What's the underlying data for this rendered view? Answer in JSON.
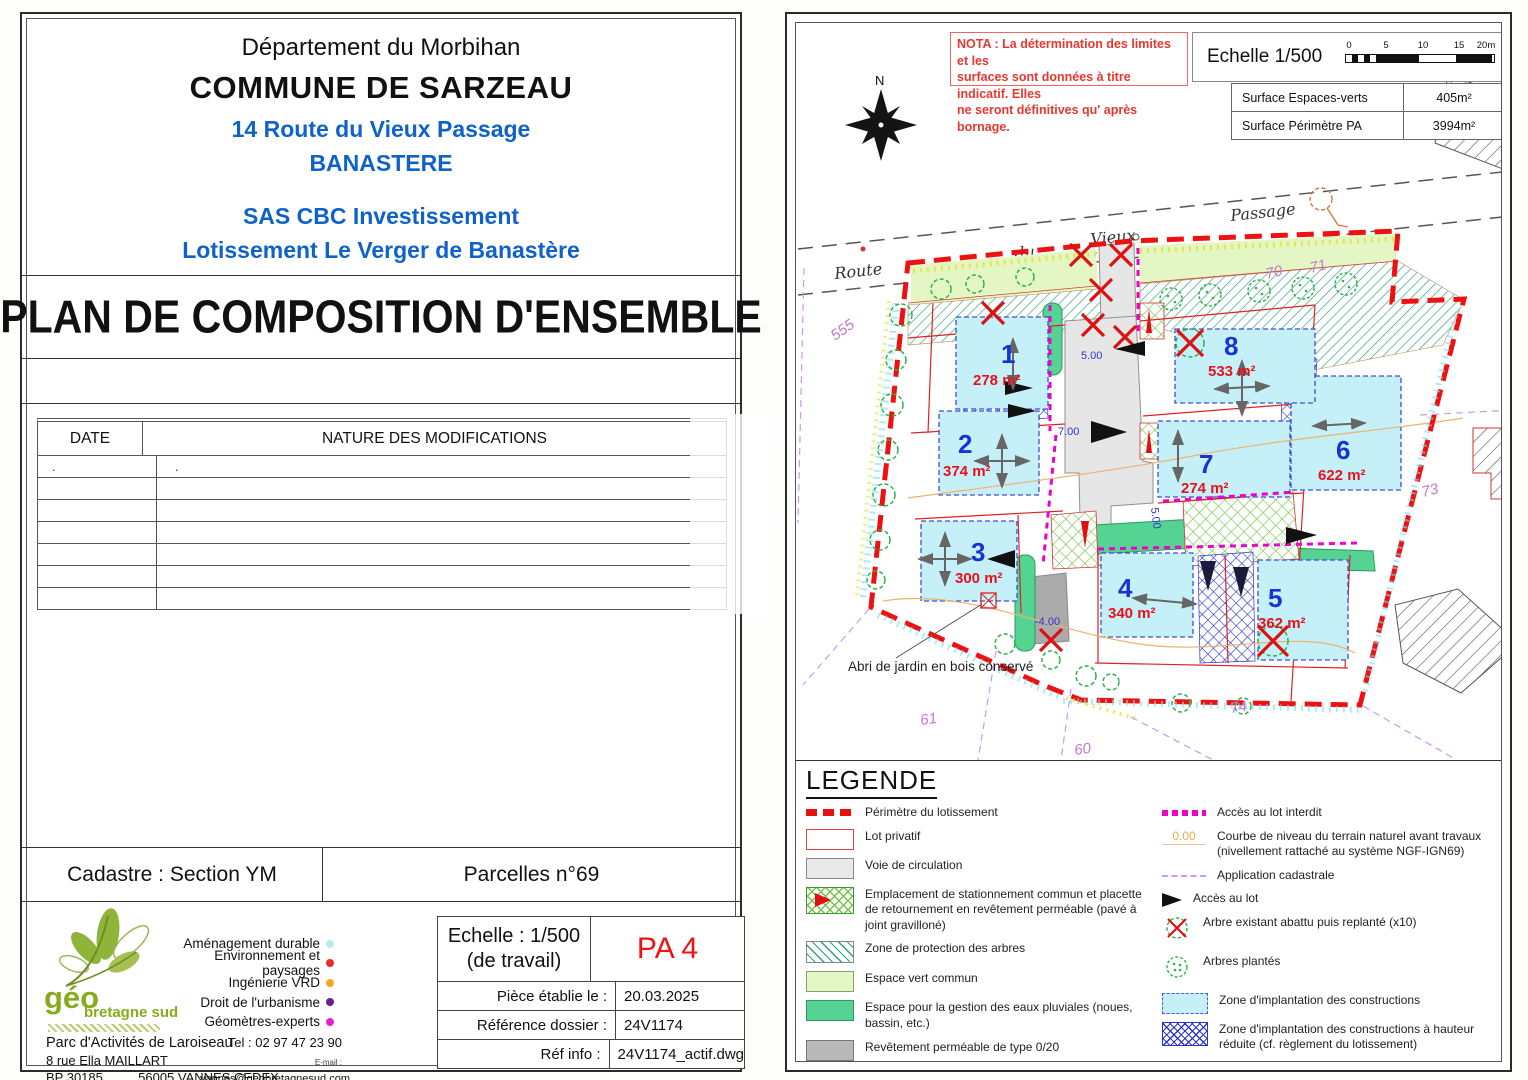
{
  "left_sheet": {
    "header": {
      "dept": "Département du Morbihan",
      "commune": "COMMUNE DE SARZEAU",
      "address": "14 Route du Vieux Passage",
      "locality": "BANASTERE",
      "applicant": "SAS CBC Investissement",
      "project": "Lotissement Le Verger de Banastère"
    },
    "title": "PLAN DE COMPOSITION D'ENSEMBLE",
    "modifications": {
      "col_date": "DATE",
      "col_nature": "NATURE DES MODIFICATIONS",
      "first_row_date": ".",
      "first_row_nature": "."
    },
    "cadastre_label": "Cadastre : Section YM",
    "parcelles_label": "Parcelles n°69",
    "firm": {
      "logo_text1": "géo",
      "logo_text2": "bretagne sud",
      "services": [
        {
          "label": "Aménagement durable",
          "color": "#b5eef2"
        },
        {
          "label": "Environnement et paysages",
          "color": "#e62b2b"
        },
        {
          "label": "Ingénierie VRD",
          "color": "#f5a81c"
        },
        {
          "label": "Droit de l'urbanisme",
          "color": "#6a1f8a"
        },
        {
          "label": "Géomètres-experts",
          "color": "#ea1fd0"
        }
      ],
      "address1": "Parc d'Activités de Laroiseau",
      "address2": "8 rue Ella MAILLART",
      "address3a": "BP 30185",
      "address3b": "56005 VANNES CEDEX",
      "tel": "Tel : 02 97 47 23 90",
      "email_label": "E-mail :",
      "email": "vannes@geobretagnesud.com",
      "web_label": "Web :",
      "web": "www.geobretagnesud.com"
    },
    "cartouche": {
      "echelle1": "Echelle : 1/500",
      "echelle2": "(de travail)",
      "piece": "PA 4",
      "row1_label": "Pièce établie le :",
      "row1_value": "20.03.2025",
      "row2_label": "Référence dossier :",
      "row2_value": "24V1174",
      "row3_label": "Réf info :",
      "row3_value": "24V1174_actif.dwg"
    }
  },
  "plan": {
    "nota": {
      "line1": "NOTA : La détermination des limites et les",
      "line2": "surfaces sont données à titre indicatif. Elles",
      "line3": "ne  seront définitives qu' après bornage."
    },
    "scale": {
      "label": "Echelle 1/500",
      "ticks": [
        "0",
        "5",
        "10",
        "15",
        "20m"
      ]
    },
    "surfaces": [
      {
        "label": "Surface Espaces-verts",
        "value": "405m²"
      },
      {
        "label": "Surface Périmètre PA",
        "value": "3994m²"
      }
    ],
    "compass_label": "N",
    "road_words": [
      "Route",
      "du",
      "Vieux",
      "Passage"
    ],
    "lots": [
      {
        "num": "1",
        "area": "278 m²"
      },
      {
        "num": "2",
        "area": "374 m²"
      },
      {
        "num": "3",
        "area": "300 m²"
      },
      {
        "num": "4",
        "area": "340 m²"
      },
      {
        "num": "5",
        "area": "362 m²"
      },
      {
        "num": "6",
        "area": "622 m²"
      },
      {
        "num": "7",
        "area": "274 m²"
      },
      {
        "num": "8",
        "area": "533 m²"
      }
    ],
    "parcels": [
      {
        "text": "555"
      },
      {
        "text": "70"
      },
      {
        "text": "71"
      },
      {
        "text": "73"
      },
      {
        "text": "74"
      },
      {
        "text": "61"
      },
      {
        "text": "60"
      }
    ],
    "dims": [
      {
        "text": "5.00"
      },
      {
        "text": "7.00"
      },
      {
        "text": "-4.00"
      },
      {
        "text": "5.00"
      }
    ],
    "annotation": "Abri de jardin en bois conservé",
    "legend": {
      "title": "LEGENDE",
      "contour_value": "0.00",
      "left": [
        "Périmètre du lotissement",
        "Lot privatif",
        "Voie de circulation",
        "Emplacement de stationnement commun et placette de retournement en revêtement perméable (pavé à joint gravilloné)",
        "Zone de protection des arbres",
        "Espace vert commun",
        "Espace pour la gestion des eaux pluviales (noues, bassin, etc.)",
        "Revêtement perméable de type 0/20",
        "Busage à prévoir"
      ],
      "right": [
        "Accès au lot interdit",
        "Courbe de niveau du terrain naturel avant travaux (nivellement rattaché au système NGF-IGN69)",
        "Application cadastrale",
        "Accès au lot",
        "Arbre existant abattu puis replanté (x10)",
        "Arbres plantés",
        "Zone d'implantation des constructions",
        "Zone d'implantation des constructions à hauteur réduite (cf. règlement du lotissement)",
        "Sens de faîtage principal des constructions"
      ]
    }
  }
}
